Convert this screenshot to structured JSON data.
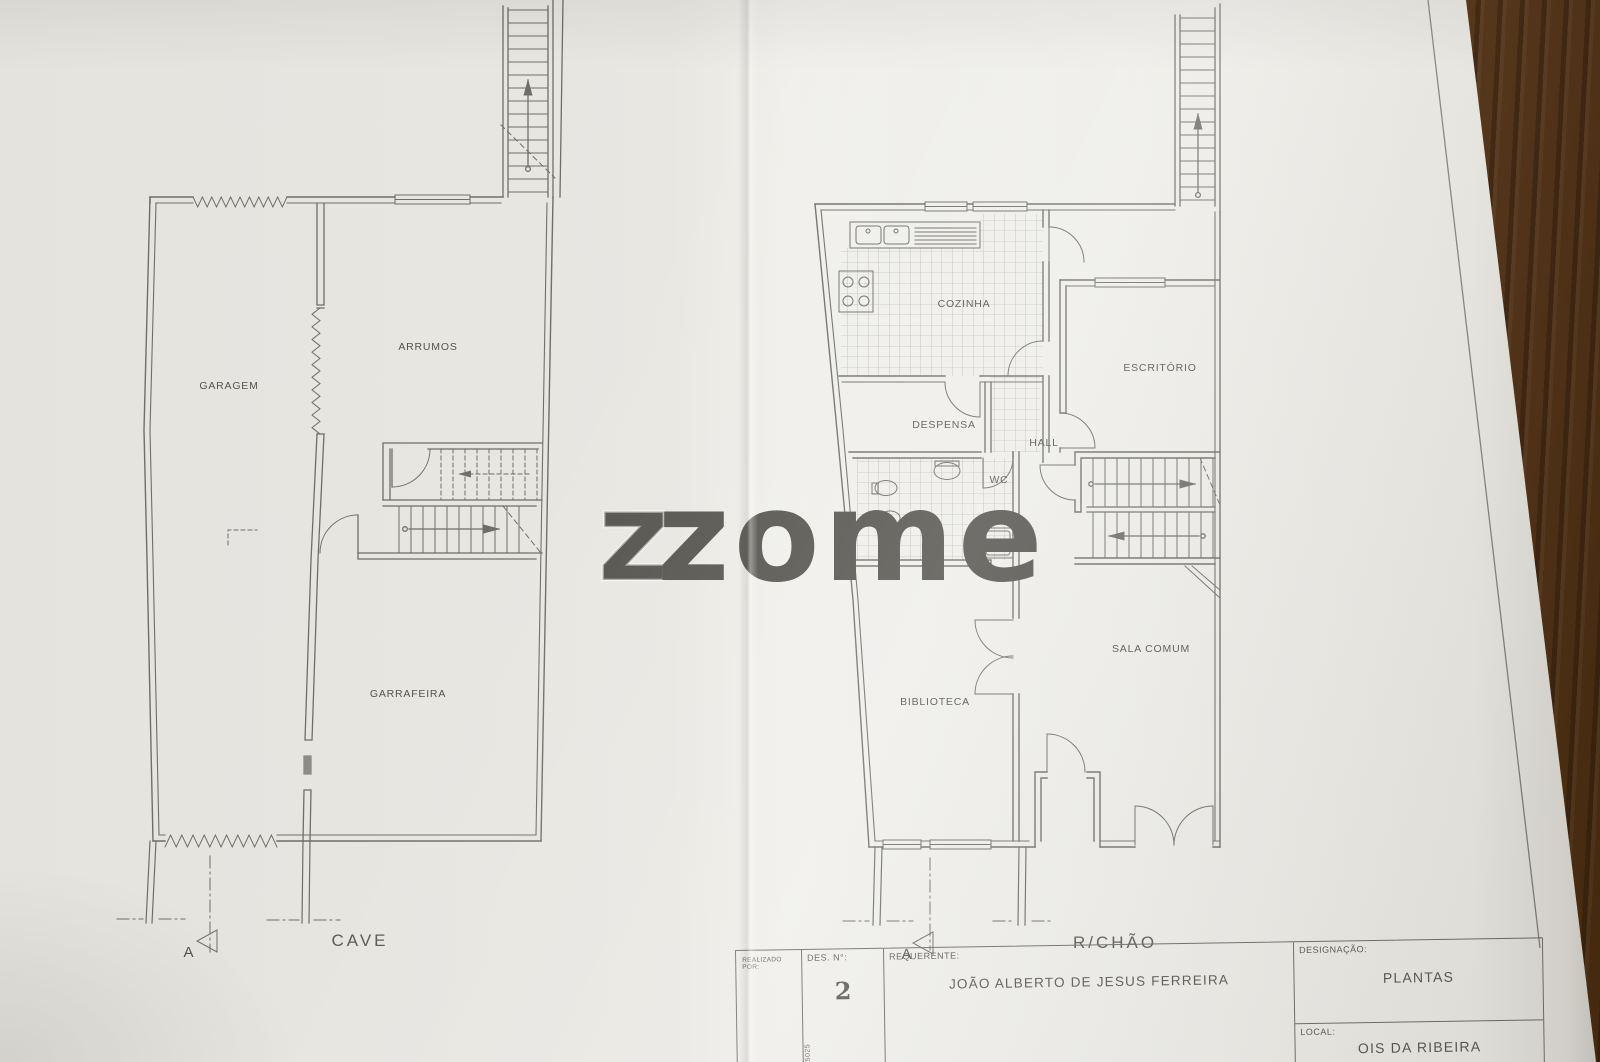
{
  "colors": {
    "paper": "#eceae5",
    "wood": "#5a3a22",
    "line": "#6f6e69",
    "text": "#54534e",
    "watermark": "#ffffff"
  },
  "watermark": {
    "brand": "zome",
    "outline_glyph": "z"
  },
  "plans": {
    "cave": {
      "title": "CAVE",
      "section_marker": "A",
      "rooms": [
        {
          "label": "GARAGEM"
        },
        {
          "label": "ARRUMOS"
        },
        {
          "label": "GARRAFEIRA"
        }
      ]
    },
    "rchao": {
      "title": "R/CHÃO",
      "section_marker": "A",
      "rooms": [
        {
          "label": "COZINHA"
        },
        {
          "label": "ESCRITÓRIO"
        },
        {
          "label": "DESPENSA"
        },
        {
          "label": "HALL"
        },
        {
          "label": "WC"
        },
        {
          "label": "SALA COMUM"
        },
        {
          "label": "BIBLIOTECA"
        }
      ]
    }
  },
  "title_block": {
    "realizado_label": "REALIZADO POR:",
    "des_label": "DES. N°:",
    "des_value": "2",
    "requerente_label": "REQUERENTE:",
    "requerente_value": "JOÃO ALBERTO DE JESUS FERREIRA",
    "designacao_label": "DESIGNAÇÃO:",
    "designacao_value": "PLANTAS",
    "local_label": "LOCAL:",
    "local_value": "OIS DA RIBEIRA",
    "side_code": "0831-65025"
  }
}
